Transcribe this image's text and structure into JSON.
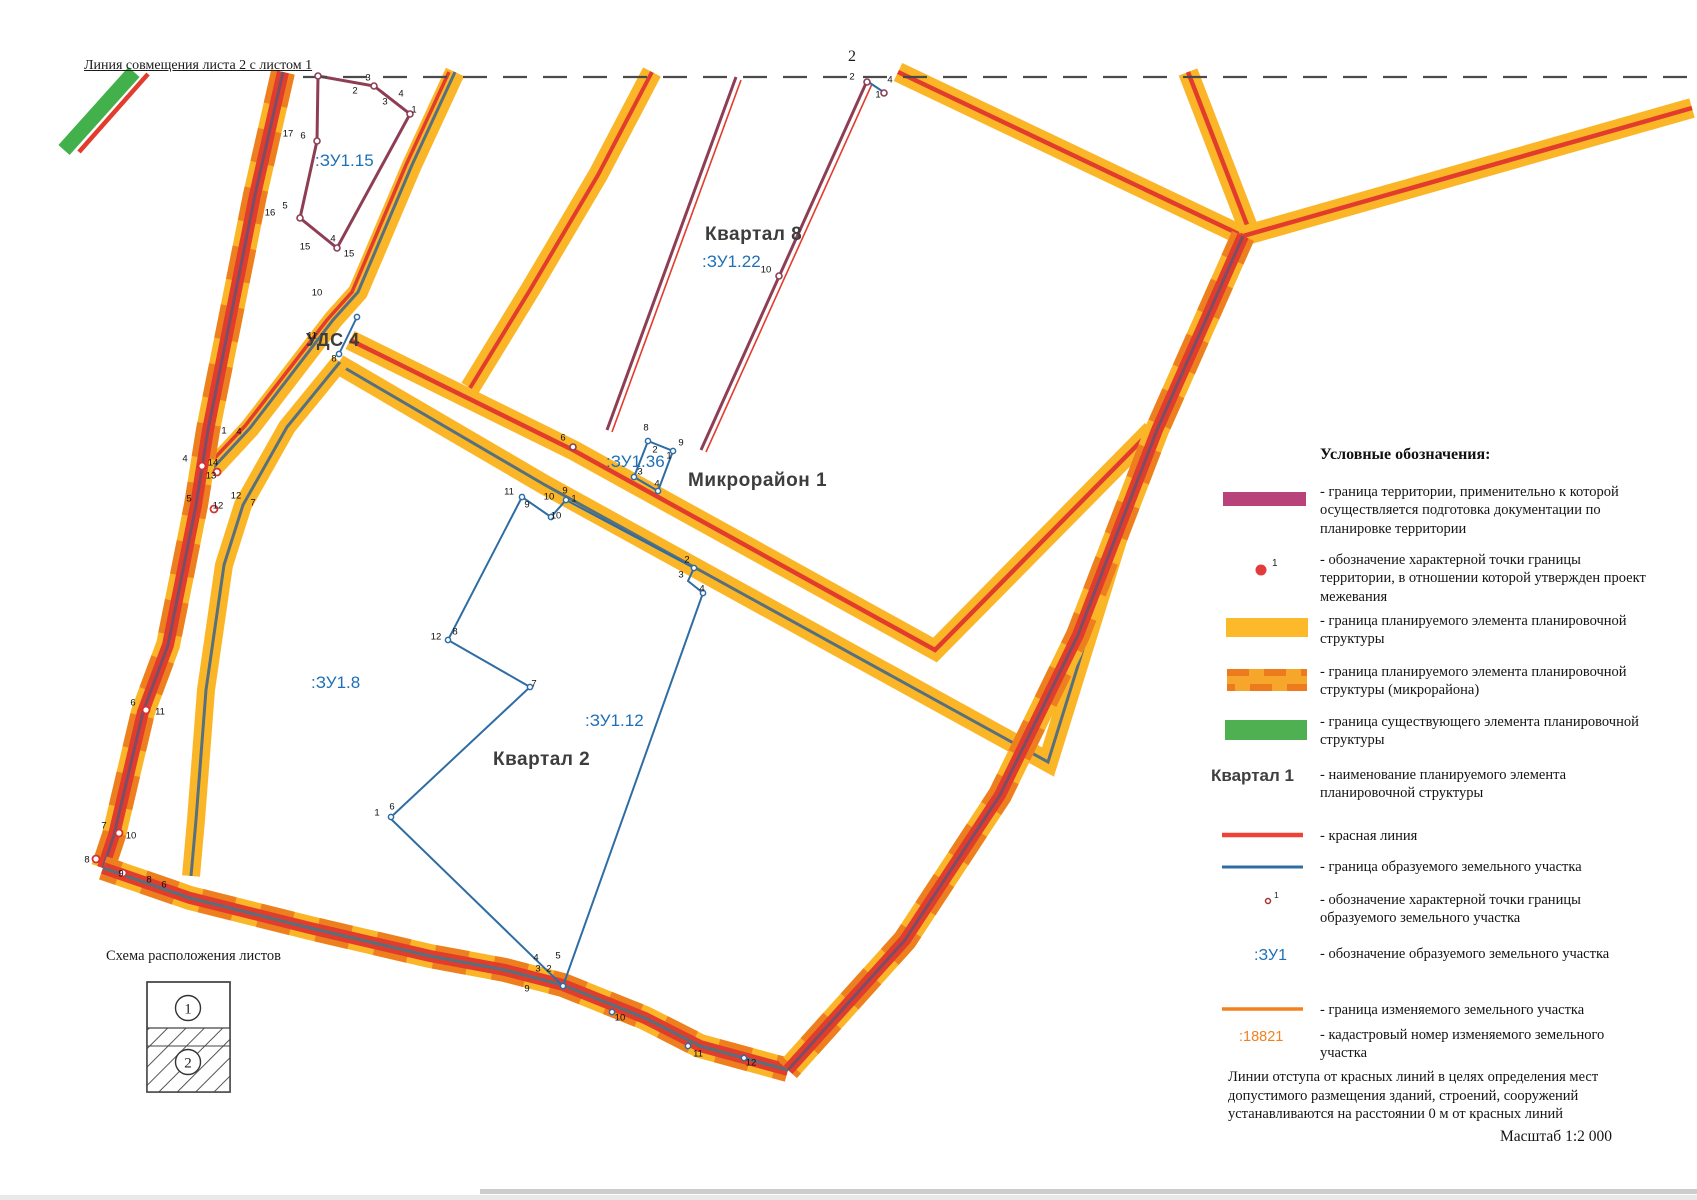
{
  "page": {
    "alignment_note": "Линия совмещения листа 2 с листом  1",
    "page_number": "2",
    "scale_label": "Масштаб 1:2 000",
    "bottom_note": "Линии отступа от красных линий в целях определения мест допустимого размещения зданий, строений, сооружений устанавливаются на расстоянии 0 м от красных линий"
  },
  "schema": {
    "title": "Схема расположения листов",
    "sheet1": "1",
    "sheet2": "2"
  },
  "legend": {
    "title": "Условные обозначения:",
    "entries": [
      {
        "swatch": "territory-bar",
        "text": "- граница территории, применительно к которой осуществляется подготовка документации по планировке территории"
      },
      {
        "swatch": "territory-point",
        "point_label": "1",
        "text": "- обозначение характерной точки границы территории, в отношении которой утвержден проект межевания"
      },
      {
        "swatch": "planned-element-bar",
        "text": "- граница планируемого элемента планировочной структуры"
      },
      {
        "swatch": "microdistrict-bar",
        "text": "- граница планируемого элемента планировочной структуры (микрорайона)"
      },
      {
        "swatch": "existing-element-bar",
        "text": "- граница существующего элемента планировочной структуры"
      },
      {
        "swatch": "kvartal-name",
        "label": "Квартал 1",
        "text": "- наименование планируемого элемента планировочной структуры"
      },
      {
        "swatch": "red-line",
        "text": "- красная линия"
      },
      {
        "swatch": "blue-line",
        "text": "- граница образуемого земельного участка"
      },
      {
        "swatch": "parcel-point",
        "point_label": "1",
        "text": "- обозначение характерной точки границы образуемого земельного участка"
      },
      {
        "swatch": "zu-designation",
        "label": ":ЗУ1",
        "text": "- обозначение образуемого земельного участка"
      },
      {
        "swatch": "orange-line",
        "text": "- граница изменяемого земельного участка"
      },
      {
        "swatch": "cadastre-number",
        "label": ":18821",
        "text": "- кадастровый номер изменяемого земельного участка"
      }
    ]
  },
  "map": {
    "labels": [
      {
        "text": ":ЗУ1.15",
        "x": 315,
        "y": 151,
        "cls": "zu"
      },
      {
        "text": "Квартал 8",
        "x": 705,
        "y": 224,
        "cls": "kvartal"
      },
      {
        "text": ":ЗУ1.22",
        "x": 702,
        "y": 252,
        "cls": "zu"
      },
      {
        "text": "УДС 4",
        "x": 306,
        "y": 330,
        "cls": "kvartal uds"
      },
      {
        "text": ":ЗУ1.36",
        "x": 606,
        "y": 452,
        "cls": "zu"
      },
      {
        "text": "Микрорайон 1",
        "x": 688,
        "y": 470,
        "cls": "kvartal"
      },
      {
        "text": ":ЗУ1.8",
        "x": 311,
        "y": 673,
        "cls": "zu"
      },
      {
        "text": ":ЗУ1.12",
        "x": 585,
        "y": 711,
        "cls": "zu"
      },
      {
        "text": "Квартал 2",
        "x": 493,
        "y": 749,
        "cls": "kvartal"
      }
    ],
    "point_labels": [
      {
        "t": "3",
        "x": 368,
        "y": 78
      },
      {
        "t": "2",
        "x": 355,
        "y": 91
      },
      {
        "t": "17",
        "x": 288,
        "y": 134
      },
      {
        "t": "6",
        "x": 303,
        "y": 136
      },
      {
        "t": "3",
        "x": 385,
        "y": 102
      },
      {
        "t": "4",
        "x": 401,
        "y": 94
      },
      {
        "t": "1",
        "x": 414,
        "y": 110
      },
      {
        "t": "16",
        "x": 270,
        "y": 213
      },
      {
        "t": "5",
        "x": 285,
        "y": 206
      },
      {
        "t": "15",
        "x": 305,
        "y": 247
      },
      {
        "t": "4",
        "x": 333,
        "y": 239
      },
      {
        "t": "15",
        "x": 349,
        "y": 254
      },
      {
        "t": "2",
        "x": 852,
        "y": 77
      },
      {
        "t": "4",
        "x": 890,
        "y": 80
      },
      {
        "t": "1",
        "x": 878,
        "y": 95
      },
      {
        "t": "10",
        "x": 766,
        "y": 270
      },
      {
        "t": "6",
        "x": 563,
        "y": 438
      },
      {
        "t": "8",
        "x": 646,
        "y": 428
      },
      {
        "t": "2",
        "x": 655,
        "y": 450
      },
      {
        "t": "9",
        "x": 681,
        "y": 443
      },
      {
        "t": "1",
        "x": 669,
        "y": 456
      },
      {
        "t": "3",
        "x": 640,
        "y": 472
      },
      {
        "t": "4",
        "x": 657,
        "y": 484
      },
      {
        "t": "10",
        "x": 317,
        "y": 293
      },
      {
        "t": "11",
        "x": 312,
        "y": 336
      },
      {
        "t": "8",
        "x": 334,
        "y": 359
      },
      {
        "t": "1",
        "x": 224,
        "y": 431
      },
      {
        "t": "4",
        "x": 239,
        "y": 432
      },
      {
        "t": "4",
        "x": 185,
        "y": 459
      },
      {
        "t": "14",
        "x": 213,
        "y": 463
      },
      {
        "t": "13",
        "x": 211,
        "y": 476
      },
      {
        "t": "5",
        "x": 189,
        "y": 499
      },
      {
        "t": "12",
        "x": 218,
        "y": 506
      },
      {
        "t": "12",
        "x": 236,
        "y": 496
      },
      {
        "t": "7",
        "x": 253,
        "y": 503
      },
      {
        "t": "6",
        "x": 133,
        "y": 703
      },
      {
        "t": "11",
        "x": 160,
        "y": 712
      },
      {
        "t": "7",
        "x": 104,
        "y": 826
      },
      {
        "t": "10",
        "x": 131,
        "y": 836
      },
      {
        "t": "8",
        "x": 87,
        "y": 860
      },
      {
        "t": "9",
        "x": 121,
        "y": 874
      },
      {
        "t": "8",
        "x": 149,
        "y": 880
      },
      {
        "t": "6",
        "x": 164,
        "y": 885
      },
      {
        "t": "4",
        "x": 536,
        "y": 958
      },
      {
        "t": "5",
        "x": 558,
        "y": 956
      },
      {
        "t": "3",
        "x": 538,
        "y": 969
      },
      {
        "t": "2",
        "x": 549,
        "y": 969
      },
      {
        "t": "9",
        "x": 527,
        "y": 989
      },
      {
        "t": "10",
        "x": 620,
        "y": 1018
      },
      {
        "t": "11",
        "x": 698,
        "y": 1054
      },
      {
        "t": "12",
        "x": 751,
        "y": 1063
      },
      {
        "t": "11",
        "x": 509,
        "y": 492
      },
      {
        "t": "9",
        "x": 527,
        "y": 505
      },
      {
        "t": "10",
        "x": 549,
        "y": 497
      },
      {
        "t": "10",
        "x": 556,
        "y": 516
      },
      {
        "t": "9",
        "x": 565,
        "y": 491
      },
      {
        "t": "1",
        "x": 574,
        "y": 499
      },
      {
        "t": "2",
        "x": 687,
        "y": 560
      },
      {
        "t": "3",
        "x": 681,
        "y": 575
      },
      {
        "t": "4",
        "x": 702,
        "y": 589
      },
      {
        "t": "12",
        "x": 436,
        "y": 637
      },
      {
        "t": "8",
        "x": 455,
        "y": 632
      },
      {
        "t": "7",
        "x": 534,
        "y": 684
      },
      {
        "t": "1",
        "x": 377,
        "y": 813
      },
      {
        "t": "6",
        "x": 392,
        "y": 807
      }
    ],
    "points": [
      {
        "x": 318,
        "y": 76,
        "k": "m"
      },
      {
        "x": 374,
        "y": 86,
        "k": "m"
      },
      {
        "x": 410,
        "y": 114,
        "k": "m"
      },
      {
        "x": 337,
        "y": 248,
        "k": "m"
      },
      {
        "x": 300,
        "y": 218,
        "k": "m"
      },
      {
        "x": 317,
        "y": 141,
        "k": "m"
      },
      {
        "x": 867,
        "y": 82,
        "k": "m"
      },
      {
        "x": 884,
        "y": 93,
        "k": "m"
      },
      {
        "x": 779,
        "y": 276,
        "k": "m"
      },
      {
        "x": 573,
        "y": 447,
        "k": "m"
      },
      {
        "x": 202,
        "y": 466,
        "k": "r"
      },
      {
        "x": 217,
        "y": 472,
        "k": "r"
      },
      {
        "x": 214,
        "y": 509,
        "k": "r"
      },
      {
        "x": 146,
        "y": 710,
        "k": "r"
      },
      {
        "x": 119,
        "y": 833,
        "k": "r"
      },
      {
        "x": 96,
        "y": 859,
        "k": "r"
      },
      {
        "x": 123,
        "y": 873,
        "k": "r"
      },
      {
        "x": 357,
        "y": 317,
        "k": "b"
      },
      {
        "x": 339,
        "y": 354,
        "k": "b"
      },
      {
        "x": 648,
        "y": 441,
        "k": "b"
      },
      {
        "x": 673,
        "y": 451,
        "k": "b"
      },
      {
        "x": 658,
        "y": 491,
        "k": "b"
      },
      {
        "x": 634,
        "y": 477,
        "k": "b"
      },
      {
        "x": 522,
        "y": 497,
        "k": "b"
      },
      {
        "x": 551,
        "y": 517,
        "k": "b"
      },
      {
        "x": 566,
        "y": 500,
        "k": "b"
      },
      {
        "x": 694,
        "y": 568,
        "k": "b"
      },
      {
        "x": 703,
        "y": 593,
        "k": "b"
      },
      {
        "x": 448,
        "y": 640,
        "k": "b"
      },
      {
        "x": 530,
        "y": 687,
        "k": "b"
      },
      {
        "x": 391,
        "y": 817,
        "k": "b"
      },
      {
        "x": 563,
        "y": 986,
        "k": "b"
      },
      {
        "x": 612,
        "y": 1012,
        "k": "b"
      },
      {
        "x": 688,
        "y": 1046,
        "k": "b"
      },
      {
        "x": 744,
        "y": 1058,
        "k": "b"
      }
    ]
  },
  "colors": {
    "road_yellow": "#fbb628",
    "road_orange_dash": "#ee7f1f",
    "red_line": "#e23c2d",
    "slate_line": "#57707e",
    "purple_line": "#7b4e68",
    "maroon_boundary": "#8e3e54",
    "legend_magenta": "#b8437a",
    "green_boundary": "#43b14b",
    "blue_parcel": "#2e6da4",
    "zu_text_blue": "#1d70b8",
    "orange_changed": "#f48120"
  }
}
